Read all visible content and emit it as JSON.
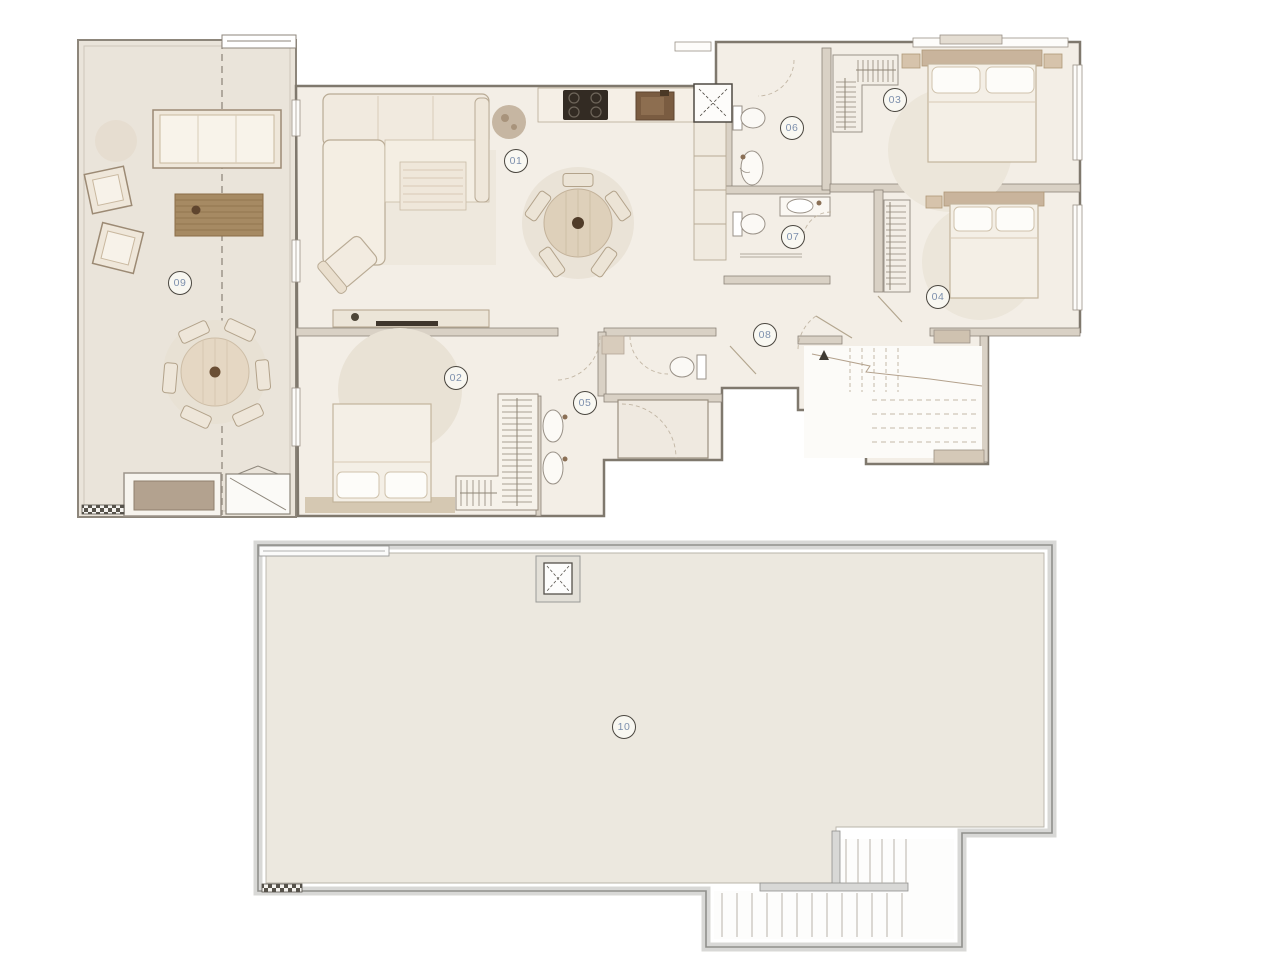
{
  "title": "duplex-floor-plan",
  "room_labels": [
    "01",
    "02",
    "03",
    "04",
    "05",
    "06",
    "07",
    "08",
    "09",
    "10"
  ],
  "levels": [
    {
      "name": "main-level",
      "label_numbers": [
        "01",
        "02",
        "03",
        "04",
        "05",
        "06",
        "07",
        "08",
        "09"
      ]
    },
    {
      "name": "roof-level",
      "label_numbers": [
        "10"
      ]
    }
  ],
  "palette": {
    "page_bg": "#ffffff",
    "interior_floor": "#f3eee6",
    "terrace_floor": "#eae4da",
    "roof_floor": "#ece8df",
    "interior_wall_fill": "#d9d1c5",
    "interior_wall_stroke": "#857d72",
    "roof_wall_fill": "#d8d8d6",
    "roof_wall_stroke": "#8f8f8c",
    "furniture_fill": "#f2ebe0",
    "furniture_stroke": "#b3a28c",
    "wood_deck": "#a68a63",
    "cooktop_dark": "#332b23",
    "sink_bronze": "#7a5c41",
    "headboard_tan": "#c9b49c",
    "rug_halo": "#ece6da",
    "label_text": "#7d90ad",
    "label_ring": "#4a463f"
  }
}
